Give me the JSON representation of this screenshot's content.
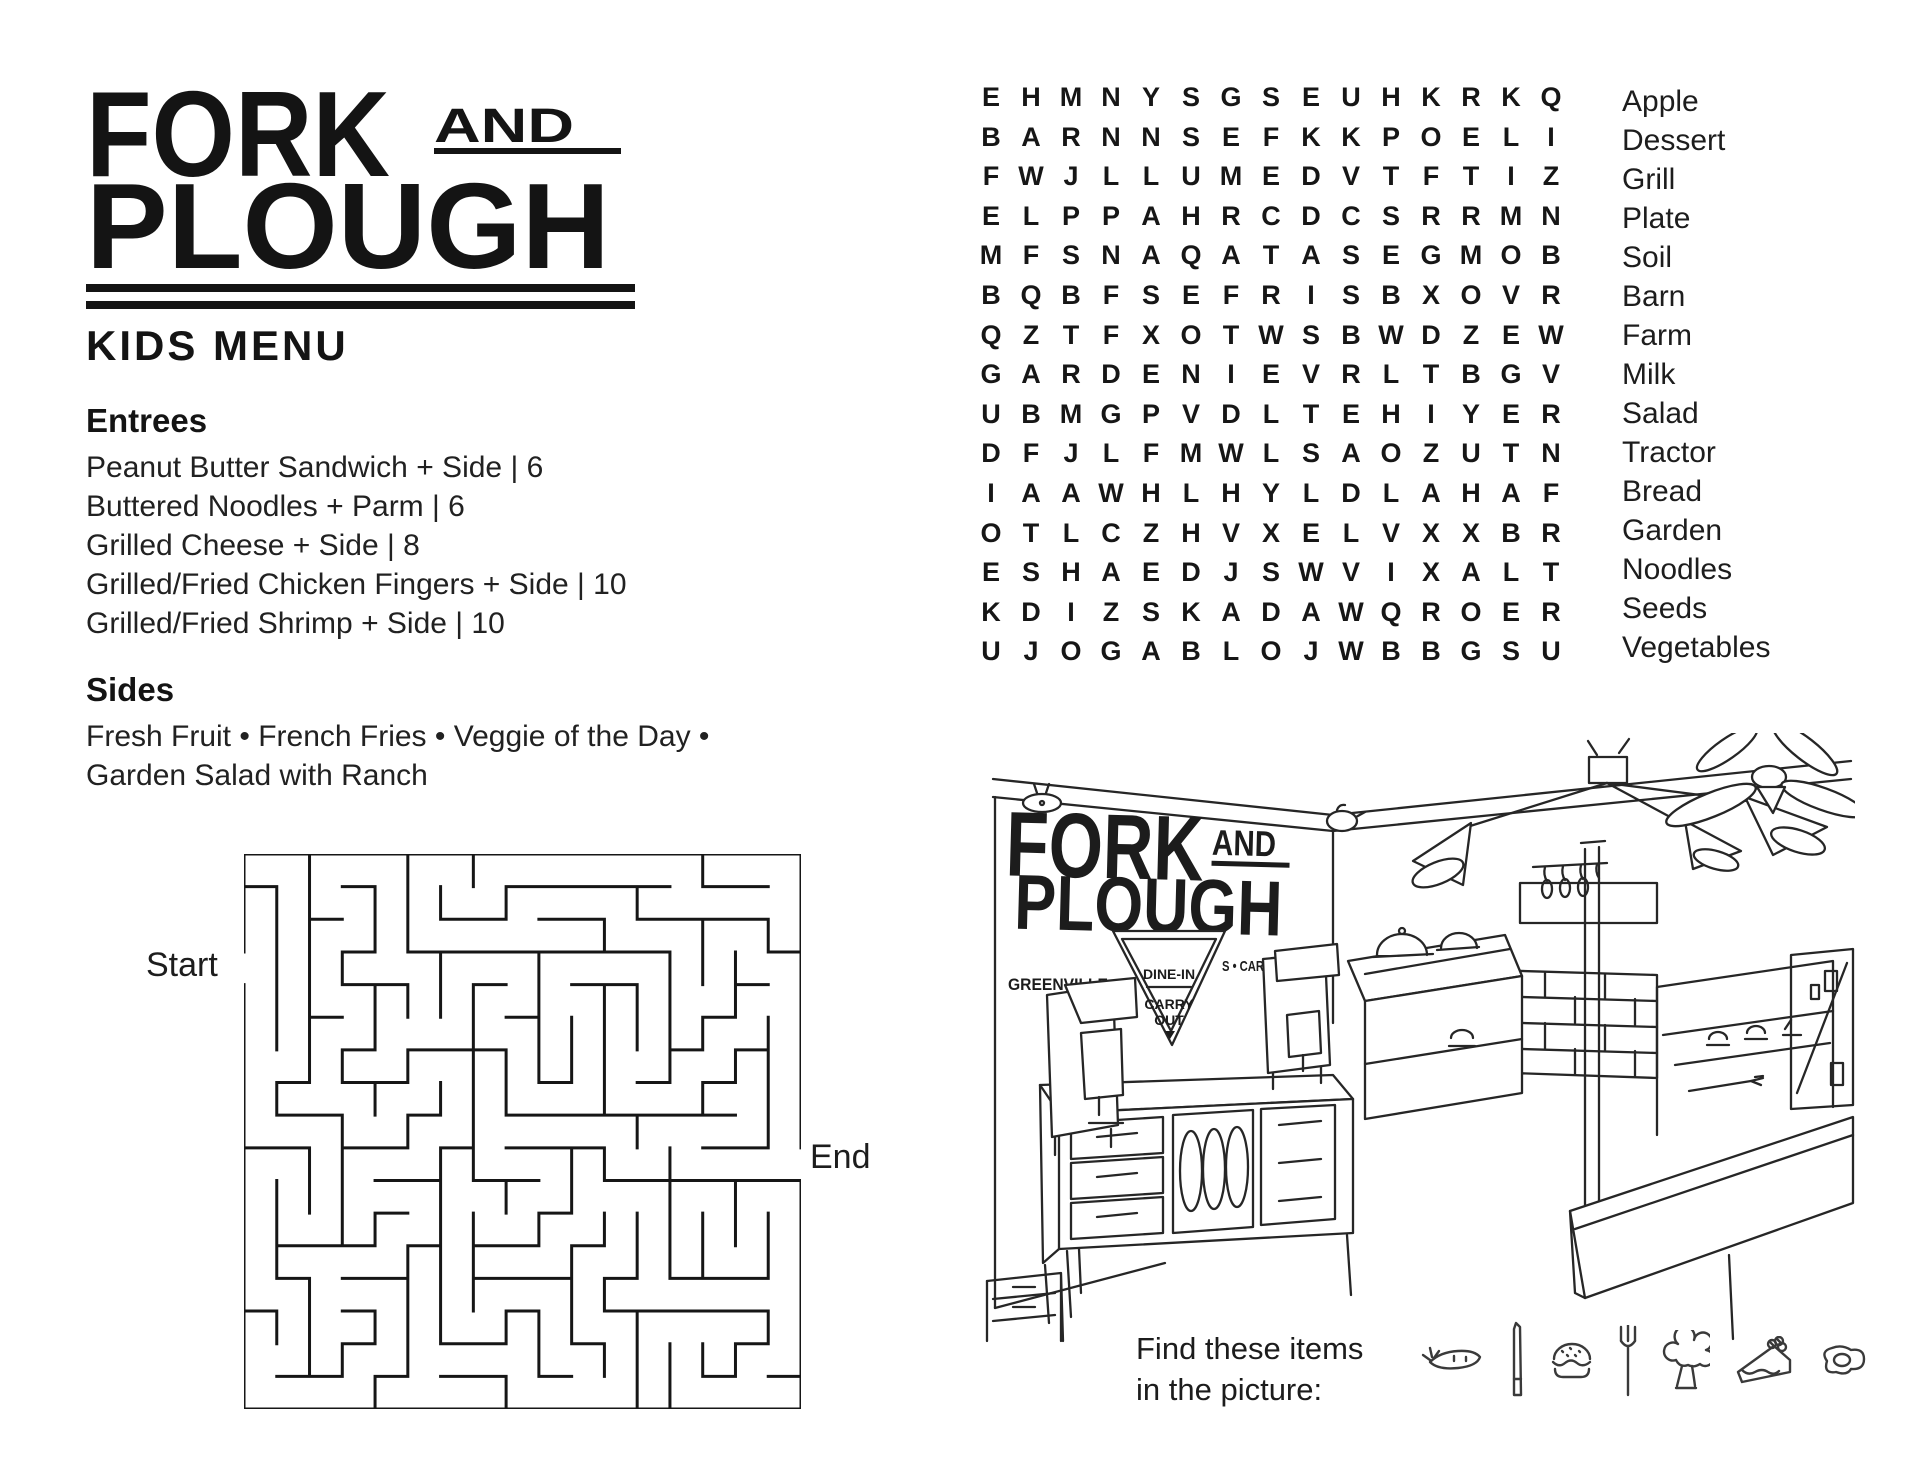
{
  "brand": {
    "word1": "FORK",
    "word2": "AND",
    "word3": "PLOUGH"
  },
  "page_title": "KIDS MENU",
  "menu": {
    "entrees_heading": "Entrees",
    "entrees": [
      "Peanut Butter Sandwich + Side | 6",
      "Buttered Noodles + Parm | 6",
      "Grilled Cheese + Side | 8",
      "Grilled/Fried Chicken Fingers + Side | 10",
      "Grilled/Fried Shrimp + Side | 10"
    ],
    "sides_heading": "Sides",
    "sides_line1": "Fresh Fruit • French Fries • Veggie of the Day •",
    "sides_line2": "Garden Salad with Ranch"
  },
  "maze": {
    "start_label": "Start",
    "end_label": "End"
  },
  "word_search": {
    "rows": [
      "EHMNYSGSEUHKRKQ",
      "BARNNSEFKKPOELI",
      "FWJLLUMEDVTFTIZ",
      "ELPPAHRCDCSRRMN",
      "MFSNAQATASEGMOB",
      "BQBFSEFRISBXOVR",
      "QZTFXOTWSBWDZEW",
      "GARDENIEVRLTBGV",
      "UBMGPVDLTEHIYER",
      "DFJLFMWLSAOZUTN",
      "IAAWHLHYLDLAHAF",
      "OTLCZHVXELVXXBR",
      "ESHAEDJSWVIXALT",
      "KDIZSKADAWQROER",
      "UJOGABLOJWBBGSU"
    ],
    "words": [
      "Apple",
      "Dessert",
      "Grill",
      "Plate",
      "Soil",
      "Barn",
      "Farm",
      "Milk",
      "Salad",
      "Tractor",
      "Bread",
      "Garden",
      "Noodles",
      "Seeds",
      "Vegetables"
    ]
  },
  "illustration": {
    "logo_word1": "FORK",
    "logo_word2": "AND",
    "logo_word3": "PLOUGH",
    "city": "GREENVILLE",
    "state_text": "S • CAR",
    "sign_line1": "DINE-IN",
    "sign_line2": "CARRY",
    "sign_line3": "OUT"
  },
  "find_items": {
    "line1": "Find these items",
    "line2": "in the picture:",
    "icons": [
      "carrot-icon",
      "knife-icon",
      "burger-icon",
      "fork-icon",
      "broccoli-icon",
      "cake-slice-icon",
      "fried-egg-icon"
    ]
  },
  "colors": {
    "ink": "#1c1c1c"
  }
}
